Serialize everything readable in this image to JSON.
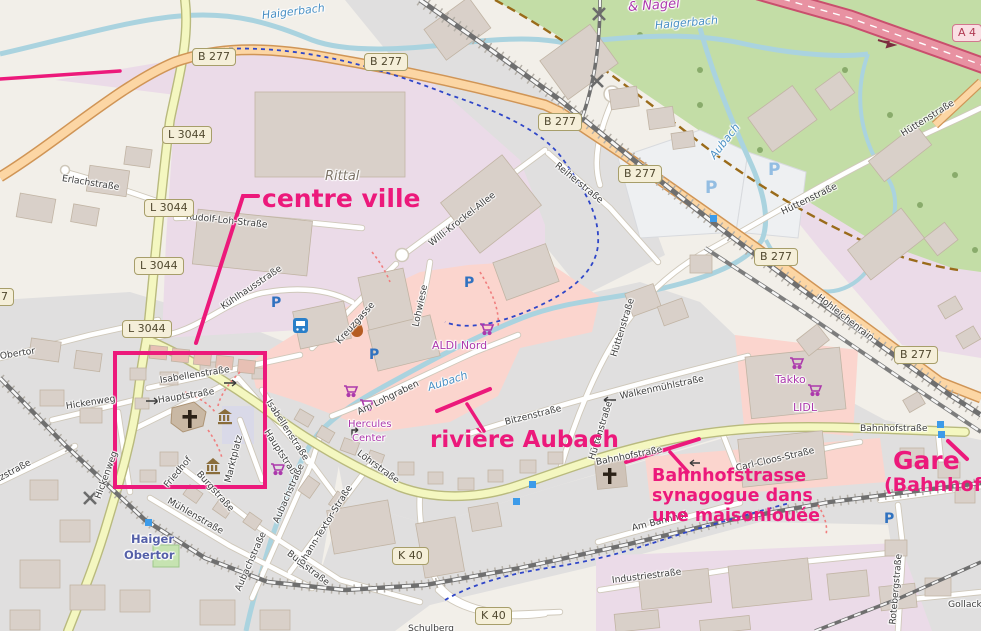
{
  "map": {
    "description": "OpenStreetMap extract of Haiger town centre with pink study annotations",
    "labels": {
      "haigerbach": "Haigerbach",
      "aubach": "Aubach",
      "rittal": "Rittal",
      "nagel": "& Nagel",
      "erlachstrasse": "Erlachstraße",
      "rudolf_loh_strasse": "Rudolf-Loh-Straße",
      "kuehlhausstrasse": "Kühlhausstraße",
      "kreuzgasse": "Kreuzgasse",
      "lohwiese": "Lohwiese",
      "willi_krockel_allee": "Willi-Krockel-Allee",
      "reiherstrasse": "Reiherstraße",
      "huettenstrasse": "Hüttenstraße",
      "hohleichenrain": "Hohleichenrain",
      "isabellenstrasse": "Isabellenstraße",
      "hauptstrasse": "Hauptstraße",
      "marktplatz": "Marktplatz",
      "friedhof": "Friedhof",
      "hickenweg": "Hickenweg",
      "obertor": "Obertor",
      "atzstrasse": "atzstraße",
      "burgstrasse": "Burgstraße",
      "muehlenstrasse": "Mühlenstraße",
      "aubachstrasse": "Aubachstraße",
      "johann_textor_strasse": "Johann-Textor-Straße",
      "loehrstrasse": "Löhrstraße",
      "bitzenstrasse": "Bitzenstraße",
      "walkenmuehlstrasse": "Walkenmühlstraße",
      "bahnhofstrasse": "Bahnhofstraße",
      "carl_cloos_strasse": "Carl-Cloos-Straße",
      "am_lohgraben": "Am Lohgraben",
      "am_bahnhof": "Am Bahnhof",
      "industriestrasse": "Industriestraße",
      "rotebergstrasse": "Rotebergstraße",
      "gollack": "Gollacke",
      "schulberg": "Schulberg",
      "aldi_nord": "ALDI Nord",
      "hercules_line1": "Hercules",
      "hercules_line2": "Center",
      "takko": "Takko",
      "lidl": "LIDL",
      "haiger": "Haiger",
      "obertor_station": "Obertor"
    },
    "badges": {
      "b277": "B 277",
      "l3044": "L 3044",
      "k40": "K 40",
      "a4": "A 4"
    },
    "icons": {
      "parking": "P"
    },
    "annotations": {
      "color": "#ec197b",
      "centre_ville": "centre ville",
      "riviere_aubach": "rivière Aubach",
      "synagogue_line1": "Bahnhofstrasse",
      "synagogue_line2": "synagogue dans",
      "synagogue_line3": "une maisonlouée",
      "gare": "Gare",
      "gare_sub": "(Bahnhof)"
    }
  }
}
